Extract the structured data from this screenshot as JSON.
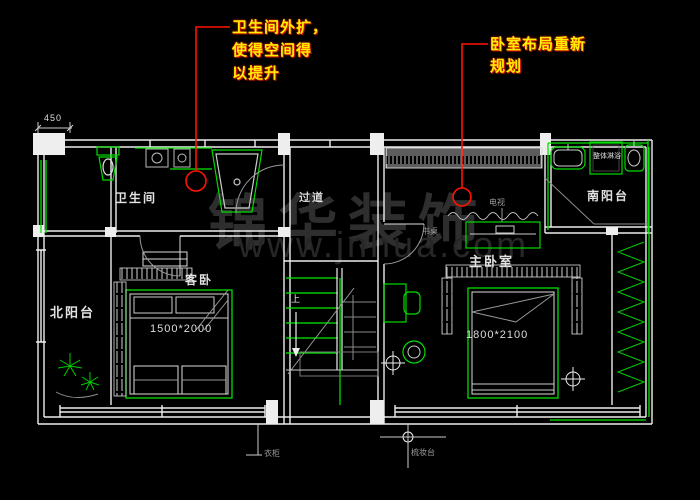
{
  "notes": {
    "note1": {
      "line1": "卫生间外扩，",
      "line2": "使得空间得",
      "line3": "以提升"
    },
    "note2": {
      "line1": "卧室布局重新",
      "line2": "规划"
    }
  },
  "rooms": {
    "bathroom": "卫生间",
    "north_balcony": "北阳台",
    "guest_bedroom": "客卧",
    "corridor": "过道",
    "master_bedroom": "主卧室",
    "south_balcony": "南阳台"
  },
  "dimensions": {
    "corner_offset": "450",
    "guest_bed": "1500*2000",
    "master_bed": "1800*2100"
  },
  "fixtures": {
    "shower_cabin": "整体淋浴",
    "tv_stand": "电视",
    "desk": "书桌",
    "wardrobe": "衣柜",
    "dressing_table": "梳妆台",
    "stairs_up": "上"
  },
  "watermark": {
    "brand": "锦华装饰",
    "site": "www.jnhua.com"
  },
  "colors": {
    "background": "#000000",
    "wall_line": "#eeeeee",
    "accent_green": "#00e600",
    "marker_red": "#ff1400",
    "note_text": "#ffee00",
    "muted_gray": "#9b9b9b"
  }
}
